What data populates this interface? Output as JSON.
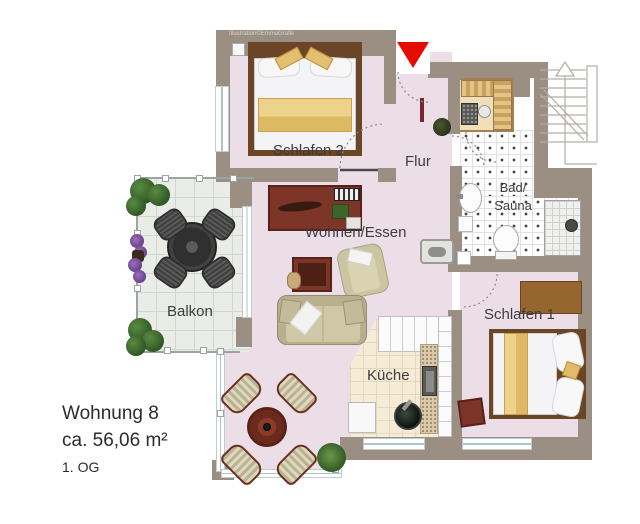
{
  "watermark": "Illustration©EmmaGrafik",
  "rooms": {
    "schlafen2": "Schlafen 2",
    "flur": "Flur",
    "wohnen_essen": "Wohnen/Essen",
    "balkon": "Balkon",
    "kueche": "Küche",
    "schlafen1": "Schlafen 1",
    "bad": "Bad/",
    "sauna": "Sauna"
  },
  "info": {
    "title": "Wohnung 8",
    "area": "ca. 56,06 m²",
    "floor": "1. OG"
  },
  "colors": {
    "wall": "#9b8f83",
    "floor": "#ecdee6",
    "entrance_marker": "#e60b00",
    "label_text": "#3d3d3d"
  }
}
